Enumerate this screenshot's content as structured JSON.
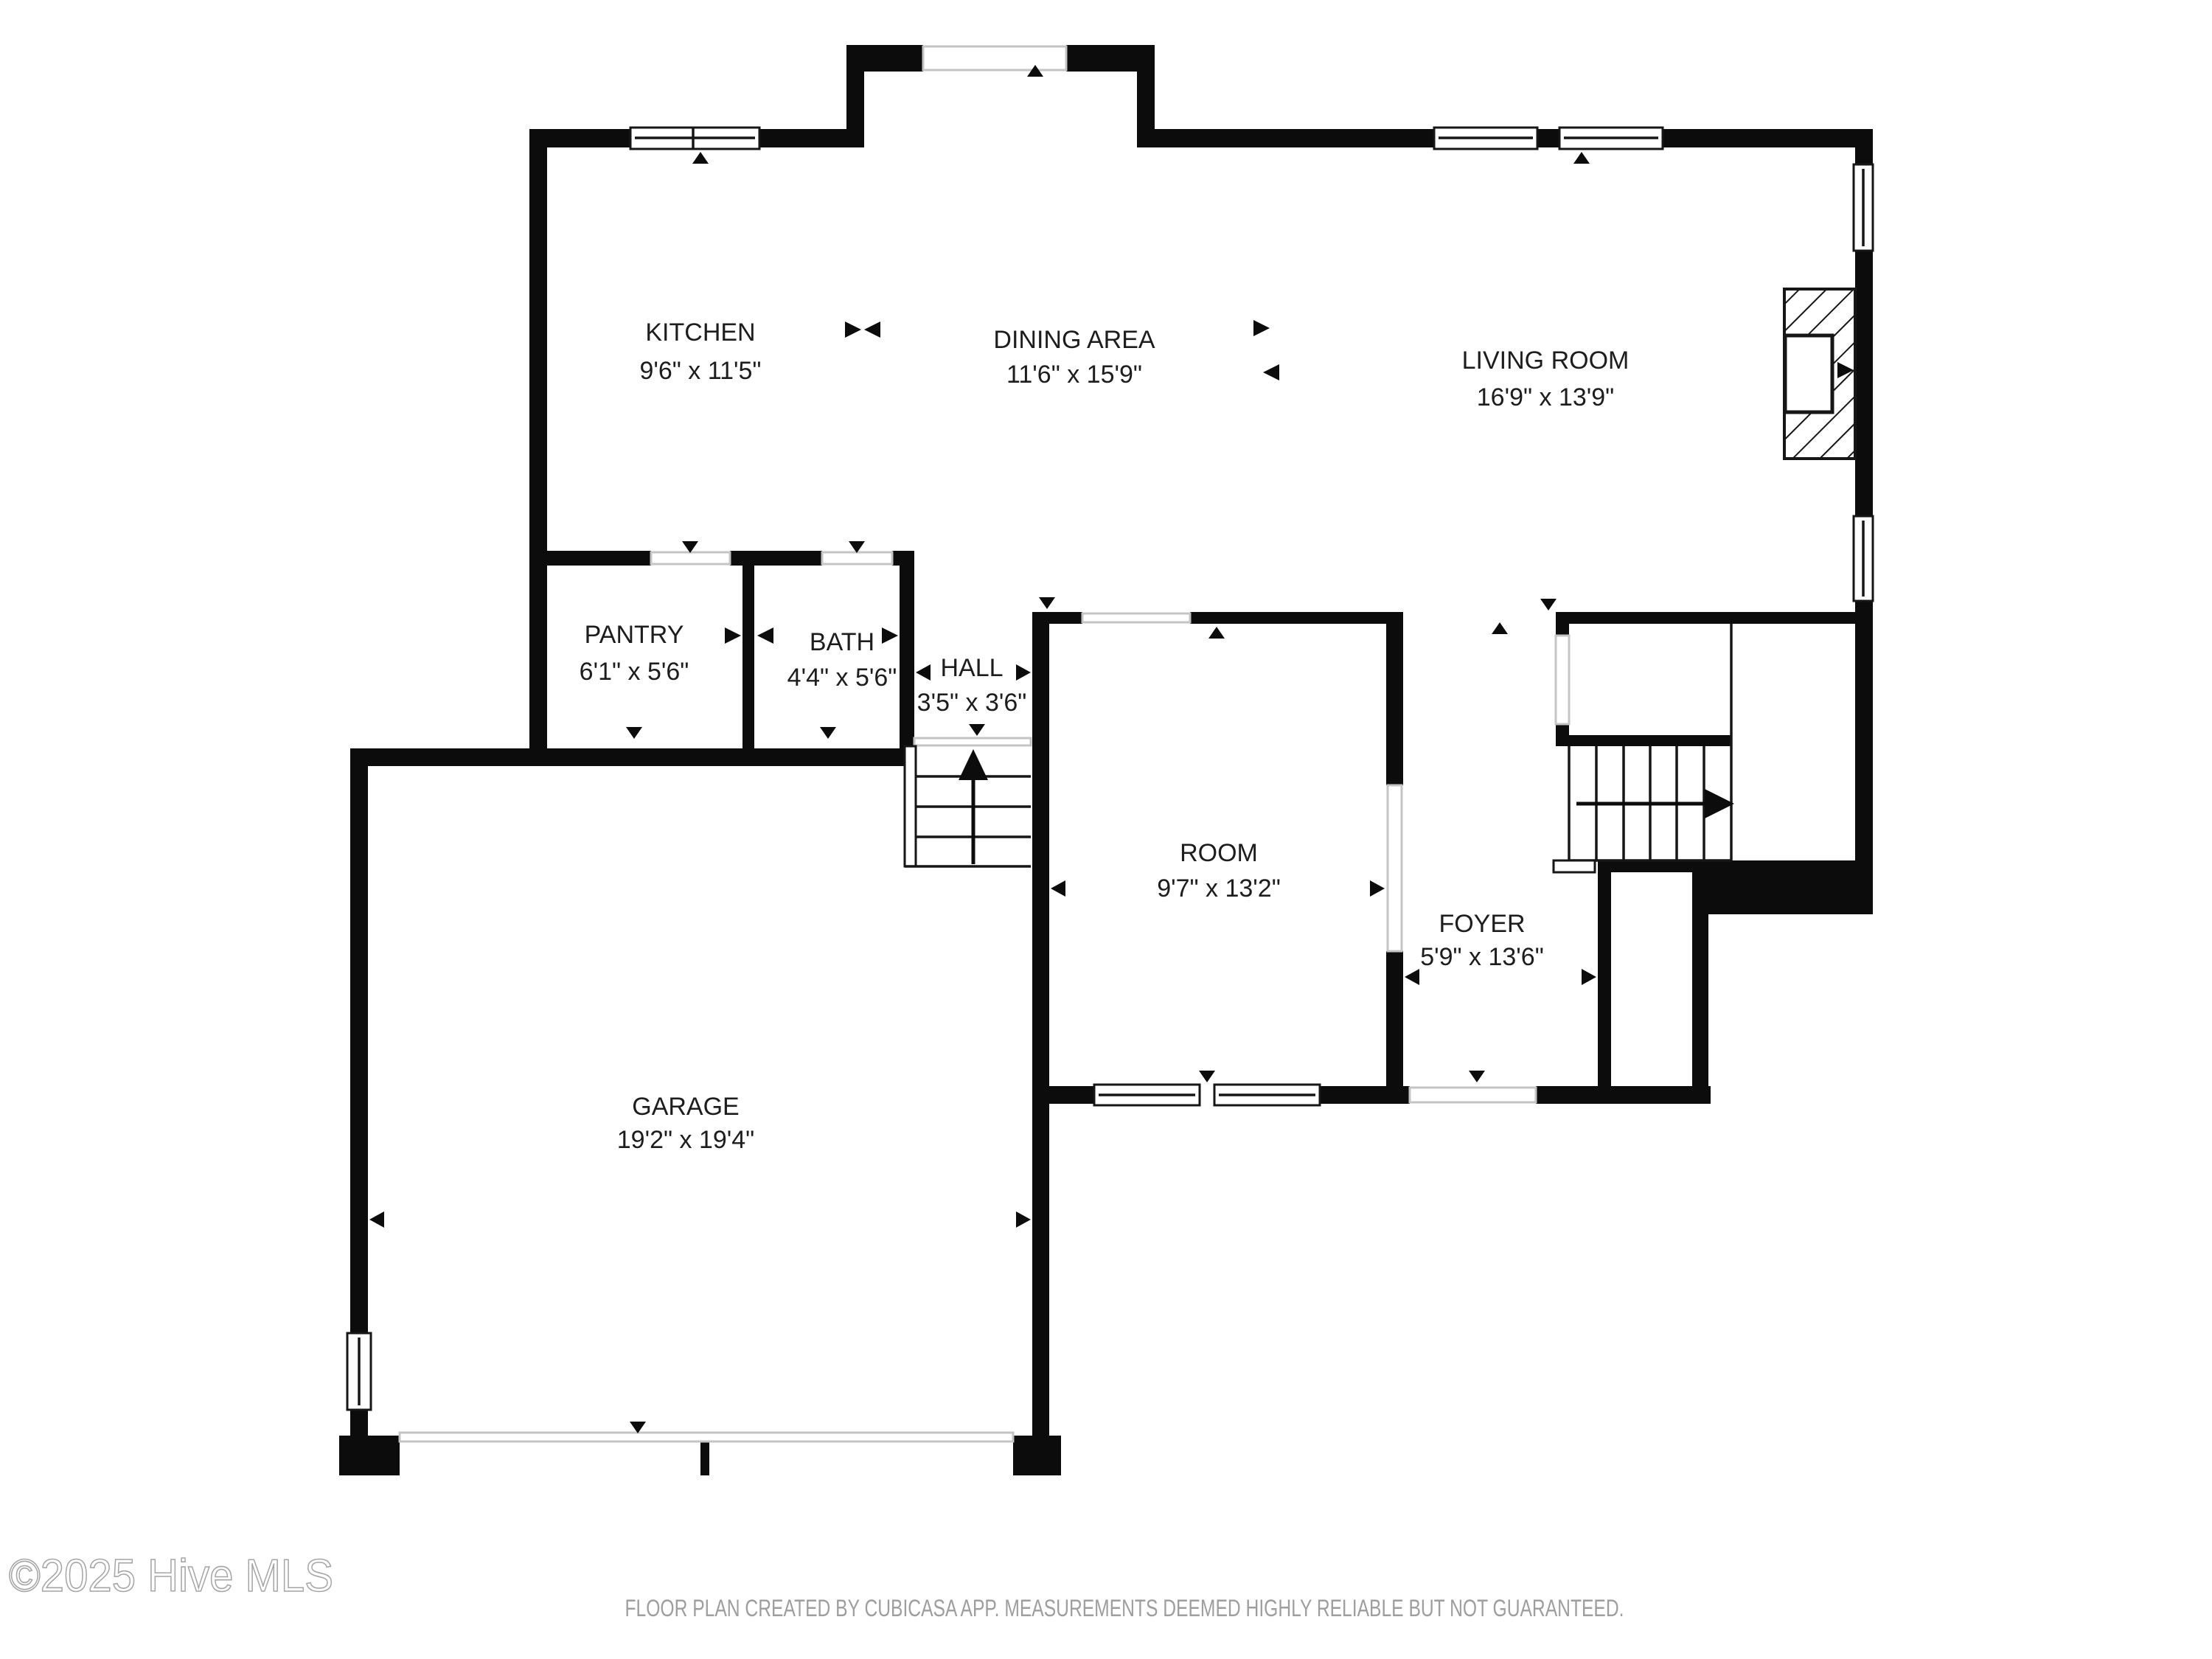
{
  "watermark": {
    "text": "©2025 Hive MLS"
  },
  "footer": {
    "text": "FLOOR PLAN CREATED BY CUBICASA APP. MEASUREMENTS DEEMED HIGHLY RELIABLE BUT NOT GUARANTEED."
  },
  "colors": {
    "wall": "#0c0c0c",
    "label_text": "#1d1d1d",
    "opening_line": "#c4c4c4",
    "footer_text": "#9e9e9e",
    "watermark_stroke": "#a5a5a5",
    "background": "#ffffff"
  },
  "rooms": {
    "kitchen": {
      "name": "KITCHEN",
      "dims": "9'6\" x 11'5\""
    },
    "dining": {
      "name": "DINING AREA",
      "dims": "11'6\" x 15'9\""
    },
    "living": {
      "name": "LIVING ROOM",
      "dims": "16'9\" x 13'9\""
    },
    "pantry": {
      "name": "PANTRY",
      "dims": "6'1\" x 5'6\""
    },
    "bath": {
      "name": "BATH",
      "dims": "4'4\" x 5'6\""
    },
    "hall": {
      "name": "HALL",
      "dims": "3'5\" x 3'6\""
    },
    "room": {
      "name": "ROOM",
      "dims": "9'7\" x 13'2\""
    },
    "foyer": {
      "name": "FOYER",
      "dims": "5'9\" x 13'6\""
    },
    "garage": {
      "name": "GARAGE",
      "dims": "19'2\" x 19'4\""
    }
  }
}
